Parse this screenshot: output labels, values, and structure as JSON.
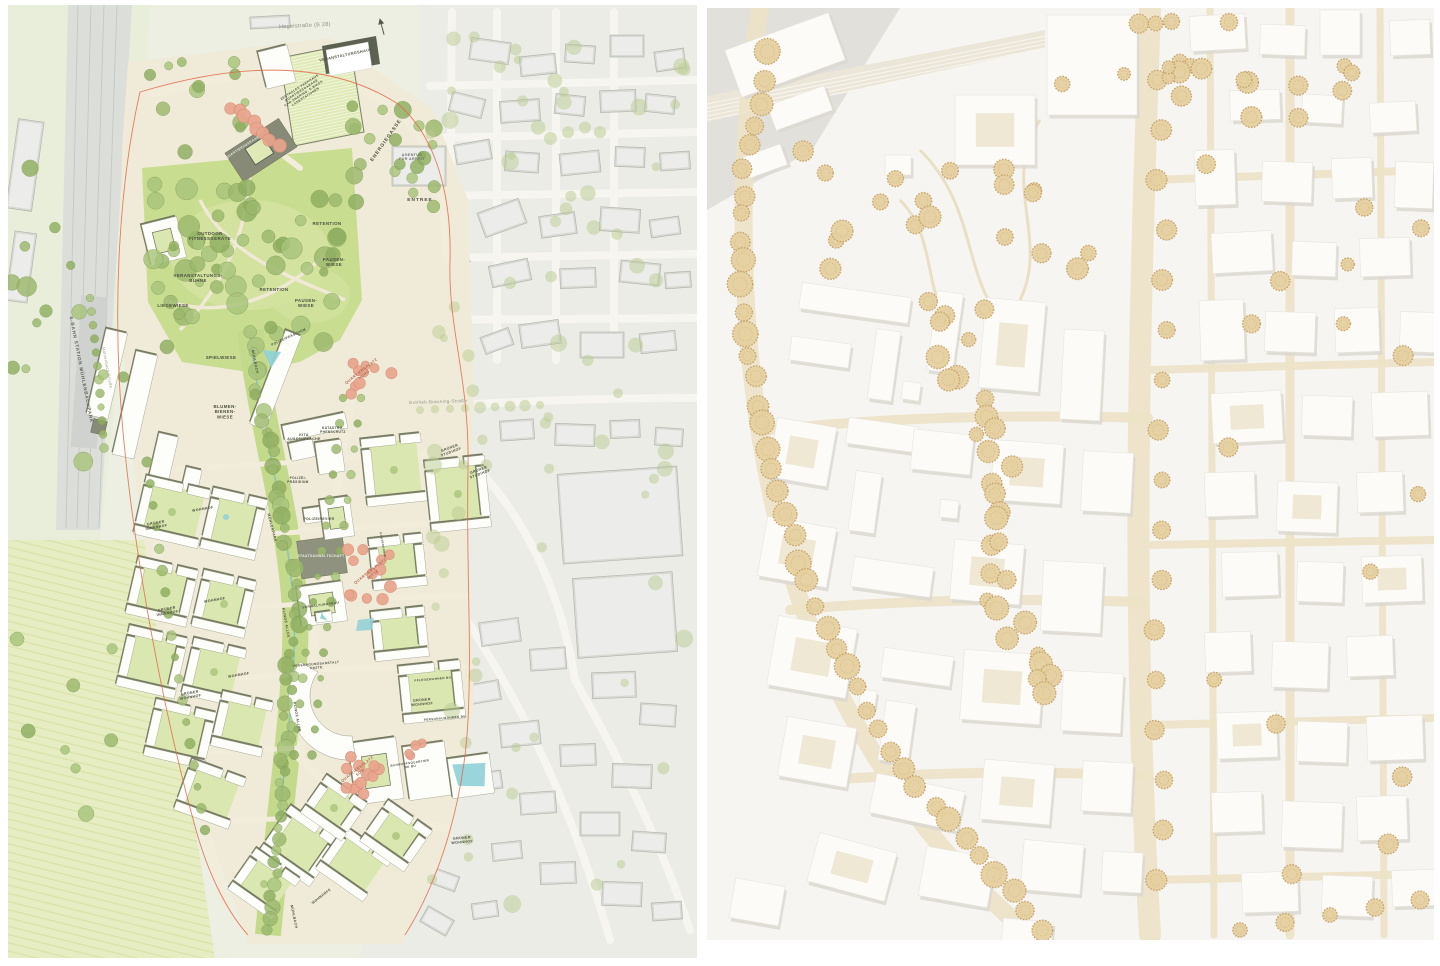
{
  "colors": {
    "plan_site_ground": "#f0ebd8",
    "plan_park_green": "#c9dd90",
    "plan_courtyard_green": "#dbe7b0",
    "plan_tree_green": "#9cb86d",
    "plan_city_gray": "#d6d8d1",
    "plan_dark_roof": "#6b7059",
    "plan_salmon_tree": "#e9a58e",
    "plan_water": "#8fd0d8",
    "plan_boundary_red": "#e06a4a",
    "plan_label_ink": "#4b4f40",
    "model_base_white": "#f6f5f1",
    "model_tree_tan": "#e5d0a0",
    "model_street_beige": "#ece2c6",
    "model_shadow": "#dbd8d0"
  },
  "left_plan": {
    "labels": [
      {
        "t": "Hegelstraße (B 28)",
        "x": 305,
        "y": 27,
        "r": -3,
        "s": 5.5,
        "c": "#8f9089",
        "w": 400,
        "ls": 0.3
      },
      {
        "t": "Gottlieb-Brauning-Straße",
        "x": 438,
        "y": 403,
        "r": -2,
        "s": 4.4,
        "c": "#8f9089",
        "w": 400
      },
      {
        "t": "Mühlenbach-Straße",
        "x": 106,
        "y": 368,
        "r": 79,
        "s": 4,
        "c": "#9a9b93",
        "w": 400
      },
      {
        "t": "S-BAHN STATION MÜHLENBACHPARK",
        "x": 80,
        "y": 370,
        "r": 79,
        "s": 4.6,
        "c": "#5f6355",
        "ls": 0.8
      },
      {
        "t": "VERANSTALTUNGSHAUS",
        "x": 346,
        "y": 56,
        "r": -12,
        "s": 3.8
      },
      {
        "lines": [
          "ZENTRALES PARKHAUS",
          "QUARTIERSGARAGE",
          "CAR-SHARING, E-BIKES",
          "LADESTATIONEN"
        ],
        "x": 300,
        "y": 88,
        "r": -33,
        "s": 3.2
      },
      {
        "t": "QUARTIERSGARAGE",
        "x": 243,
        "y": 148,
        "r": -33,
        "s": 3.2,
        "c": "#eceee4"
      },
      {
        "t": "ENERGIEGASSE",
        "x": 387,
        "y": 141,
        "r": -55,
        "s": 4.8,
        "ls": 1
      },
      {
        "lines": [
          "AGENTUR",
          "FÜR ARBEIT"
        ],
        "x": 412,
        "y": 156,
        "s": 3.6,
        "c": "#6e7268"
      },
      {
        "t": "ENTREE",
        "x": 420,
        "y": 201,
        "s": 4.8,
        "ls": 1
      },
      {
        "t": "RETENTION",
        "x": 327,
        "y": 225,
        "s": 4.4
      },
      {
        "lines": [
          "OUTDOOR",
          "FITNESSGERÄTE"
        ],
        "x": 210,
        "y": 235,
        "s": 4.4
      },
      {
        "lines": [
          "PAUSEN-",
          "WIESE"
        ],
        "x": 334,
        "y": 261,
        "s": 4.4
      },
      {
        "lines": [
          "VERANSTALTUNGS-",
          "BÜHNE"
        ],
        "x": 198,
        "y": 277,
        "s": 4.4
      },
      {
        "t": "RETENTION",
        "x": 274,
        "y": 291,
        "s": 4.4
      },
      {
        "lines": [
          "PAUSEN-",
          "WIESE"
        ],
        "x": 306,
        "y": 302,
        "s": 4.4
      },
      {
        "t": "LIEGEWIESE",
        "x": 173,
        "y": 307,
        "s": 4.4
      },
      {
        "t": "SPIELWIESE",
        "x": 221,
        "y": 359,
        "s": 4.4
      },
      {
        "t": "MÜHLBACH",
        "x": 254,
        "y": 362,
        "r": 78,
        "s": 3.6
      },
      {
        "t": "POLIZEIPRÄSIDIUM",
        "x": 289,
        "y": 338,
        "r": -25,
        "s": 3.3
      },
      {
        "lines": [
          "BLUMEN-",
          "BIENEN-",
          "WIESE"
        ],
        "x": 225,
        "y": 408,
        "s": 4.4
      },
      {
        "lines": [
          "QUARTIERSPLATZ",
          "NORD"
        ],
        "x": 362,
        "y": 372,
        "r": -38,
        "s": 3.8,
        "c": "#b06e58"
      },
      {
        "lines": [
          "KITA",
          "AUSSENFLÄCHE"
        ],
        "x": 304,
        "y": 436,
        "s": 3.5
      },
      {
        "lines": [
          "KATASTRO-",
          "PHENSCHUTZ"
        ],
        "x": 333,
        "y": 429,
        "s": 3.2
      },
      {
        "lines": [
          "GRÜNER",
          "STUDIHOF"
        ],
        "x": 450,
        "y": 449,
        "r": -20,
        "s": 3.6
      },
      {
        "lines": [
          "GRÜNER",
          "STUDIHOF"
        ],
        "x": 479,
        "y": 471,
        "r": -20,
        "s": 3.6
      },
      {
        "lines": [
          "POLIZEI-",
          "PRÄSIDIUM"
        ],
        "x": 298,
        "y": 479,
        "s": 3.2
      },
      {
        "lines": [
          "GRÜNER",
          "INNENHOF"
        ],
        "x": 156,
        "y": 524,
        "r": -10,
        "s": 3.6
      },
      {
        "t": "WOHNHOF",
        "x": 203,
        "y": 510,
        "r": -10,
        "s": 3.6
      },
      {
        "t": "MÜHLENPARK",
        "x": 271,
        "y": 528,
        "r": 76,
        "s": 3.6
      },
      {
        "t": "POLIZEIREVIER",
        "x": 319,
        "y": 520,
        "s": 3.4
      },
      {
        "t": "STAATSANWALTSCHAFT",
        "x": 321,
        "y": 557,
        "s": 3.3,
        "c": "#f0f1e9"
      },
      {
        "lines": [
          "QUARTIERSPLATZ",
          "MITTE"
        ],
        "x": 371,
        "y": 572,
        "r": -38,
        "s": 3.8,
        "c": "#b06e58"
      },
      {
        "t": "GASTRONOMIE",
        "x": 382,
        "y": 545,
        "r": 80,
        "s": 2.8
      },
      {
        "t": "KLINGE ALLEE",
        "x": 285,
        "y": 623,
        "r": 80,
        "s": 3.5
      },
      {
        "lines": [
          "GRÜNER",
          "INNENHOF"
        ],
        "x": 167,
        "y": 610,
        "r": -10,
        "s": 3.6
      },
      {
        "t": "WOHNHOF",
        "x": 215,
        "y": 601,
        "r": -10,
        "s": 3.6
      },
      {
        "t": "WOHNHOF",
        "x": 239,
        "y": 676,
        "r": -10,
        "s": 3.6
      },
      {
        "lines": [
          "GRÜNER",
          "WOHNHOF"
        ],
        "x": 190,
        "y": 694,
        "r": -10,
        "s": 3.6
      },
      {
        "t": "VERWALTUNGSBAU",
        "x": 321,
        "y": 606,
        "r": -8,
        "s": 3.2
      },
      {
        "lines": [
          "VERSORGUNGSANSTALT",
          "ÄRZTE"
        ],
        "x": 316,
        "y": 665,
        "r": -5,
        "s": 3.2
      },
      {
        "t": "PFLEGEWOHNEN BG",
        "x": 433,
        "y": 680,
        "r": -5,
        "s": 3
      },
      {
        "lines": [
          "GRÜNER",
          "WOHNHOF"
        ],
        "x": 422,
        "y": 701,
        "r": -5,
        "s": 3.6
      },
      {
        "t": "PERSONALWOHNEN BG",
        "x": 445,
        "y": 719,
        "r": -5,
        "s": 3
      },
      {
        "t": "KLINGE ALLEE",
        "x": 296,
        "y": 717,
        "r": 80,
        "s": 3.5
      },
      {
        "lines": [
          "QUARTIERSPLATZ",
          "SÜD"
        ],
        "x": 358,
        "y": 770,
        "r": -38,
        "s": 3.8,
        "c": "#b06e58"
      },
      {
        "lines": [
          "BAHNHOFSQUARTIER",
          "BK BU"
        ],
        "x": 410,
        "y": 764,
        "r": -8,
        "s": 3
      },
      {
        "lines": [
          "GRÜNER",
          "WOHNHOF"
        ],
        "x": 462,
        "y": 839,
        "r": -5,
        "s": 3.6
      },
      {
        "t": "WOHNHÖFE",
        "x": 322,
        "y": 897,
        "r": -38,
        "s": 3.4
      },
      {
        "t": "MÜHLBACH",
        "x": 293,
        "y": 917,
        "r": 78,
        "s": 3.6
      }
    ]
  },
  "right_model": {
    "labels": []
  }
}
